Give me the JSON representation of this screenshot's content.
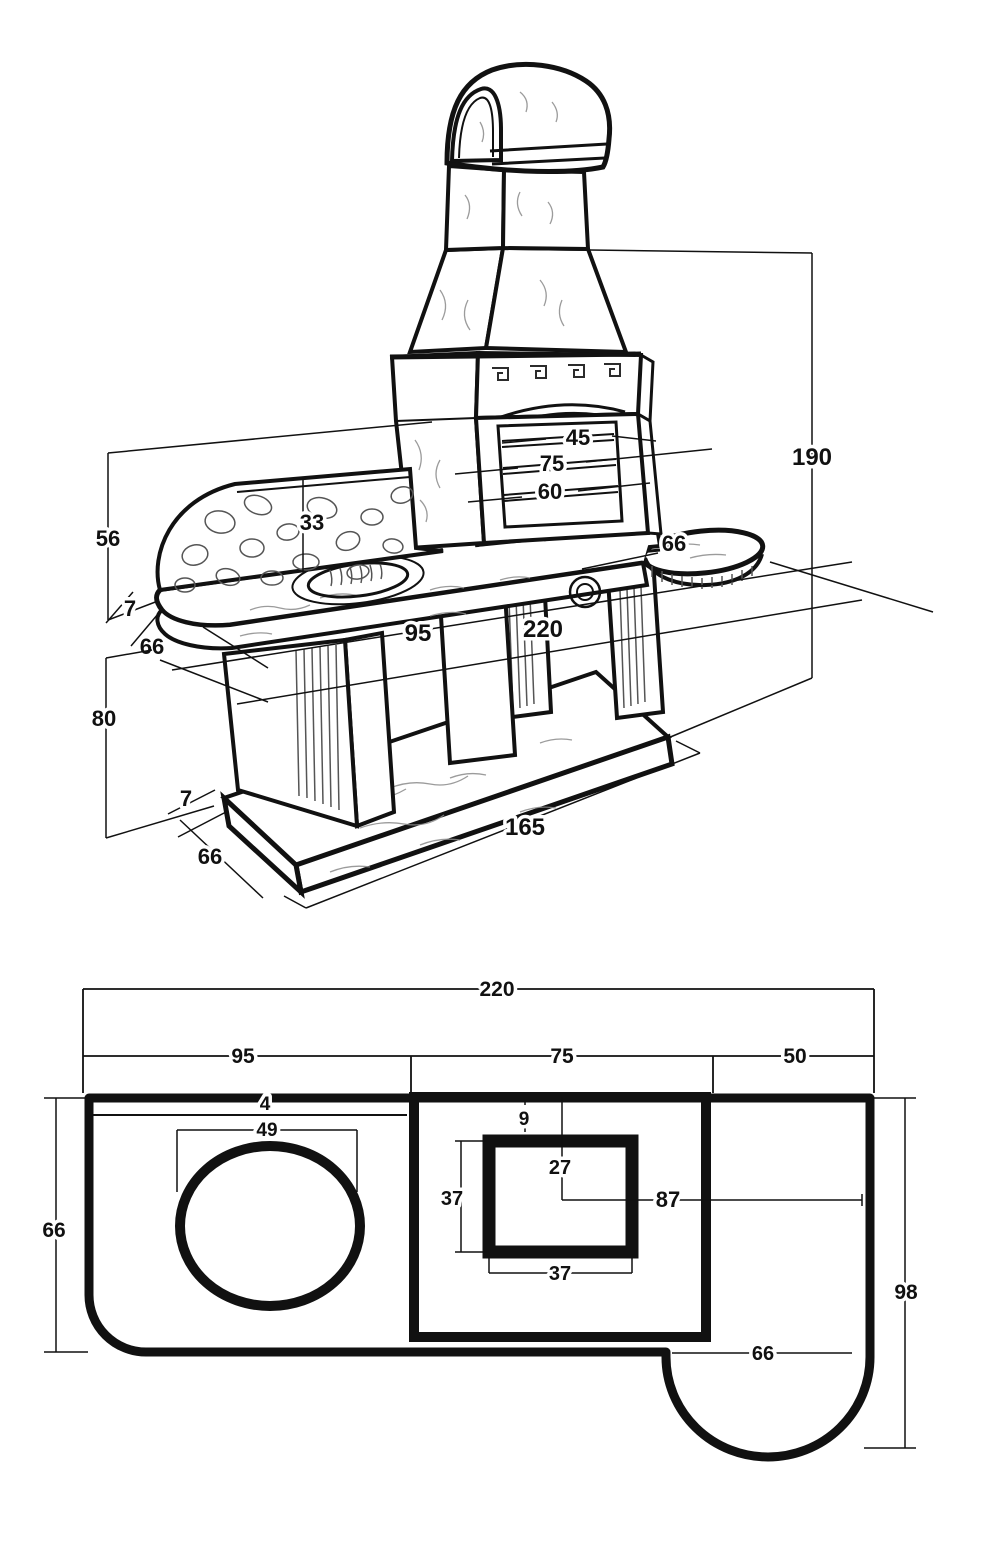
{
  "title": "Masonry barbecue dimension drawing",
  "colors": {
    "ink": "#111111",
    "background": "#ffffff",
    "texture": "#8a8a8a"
  },
  "perspective_view": {
    "dimensions": {
      "total_height": "190",
      "backsplash_height": "56",
      "worktop_thickness": "7",
      "worktop_depth": "66",
      "understructure_height": "80",
      "plinth_thickness": "7",
      "plinth_depth": "66",
      "plinth_length": "165",
      "backsplash_wall": "33",
      "worktop_length": "95",
      "total_length": "220",
      "grill_upper": "45",
      "grill_middle": "75",
      "grill_lower": "60",
      "side_table_diameter": "66"
    }
  },
  "plan_view": {
    "dimensions": {
      "total_length": "220",
      "left_section": "95",
      "middle_section": "75",
      "right_section": "50",
      "rear_edge_strip": "4",
      "sink_diameter": "49",
      "firebox_rear_gap": "9",
      "firebox_center_offset": "27",
      "firebox_depth": "37",
      "firebox_width": "37",
      "center_to_right_edge": "87",
      "worktop_depth": "66",
      "right_depth": "98",
      "side_table_width": "66"
    }
  }
}
